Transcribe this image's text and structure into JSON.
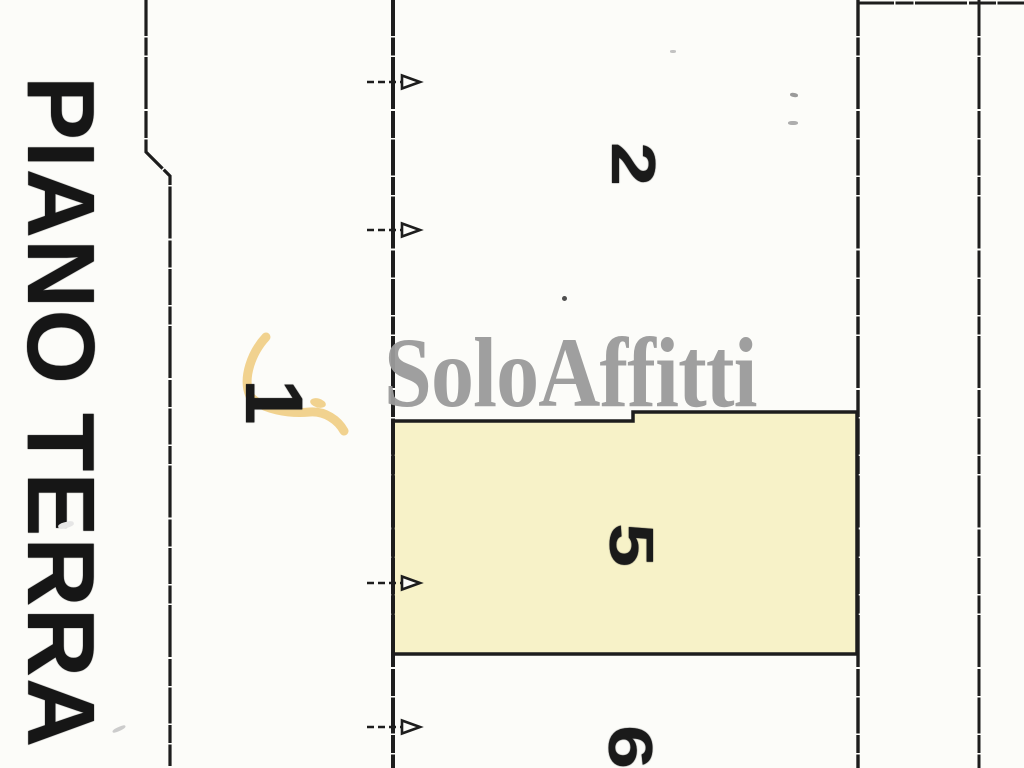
{
  "plan": {
    "floor_label": "PIANO TERRA",
    "rooms": [
      {
        "number": "1",
        "highlighted": false
      },
      {
        "number": "2",
        "highlighted": false
      },
      {
        "number": "5",
        "highlighted": true
      },
      {
        "number": "6",
        "highlighted": false
      }
    ],
    "highlight_color": "#f7f2c8",
    "ink_color": "#1d1d1d",
    "arrow_count": 4
  },
  "watermark": {
    "brand": "SoloAffitti",
    "text_color": "#9b9b9b",
    "swoosh_icon": "leaf-swoosh",
    "swoosh_color": "#f1d28f"
  }
}
